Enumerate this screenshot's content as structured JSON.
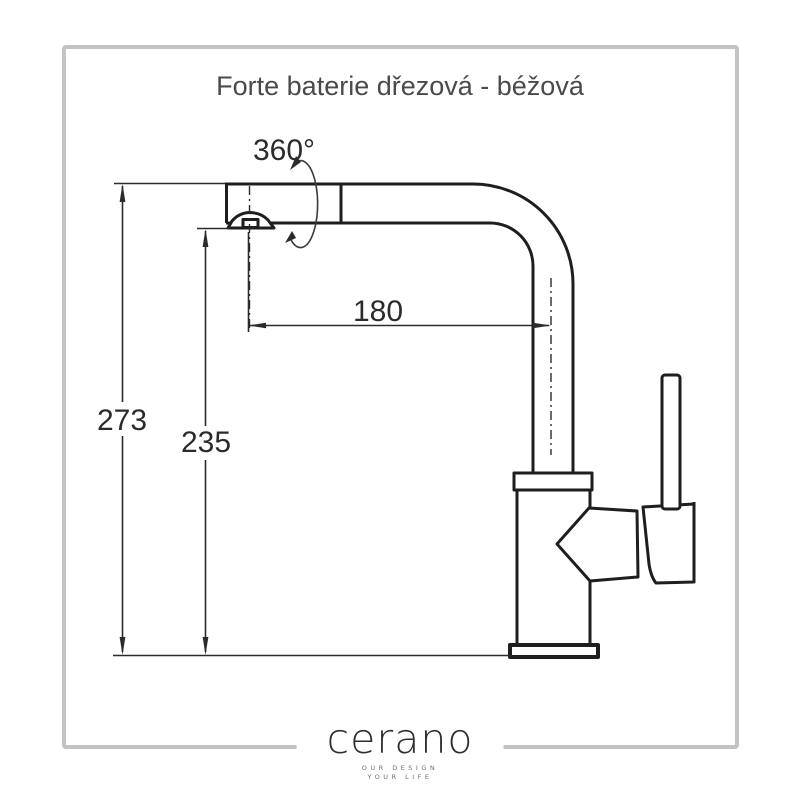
{
  "title": "Forte baterie dřezová - béžová",
  "dimensions": {
    "height_total": "273",
    "height_spout": "235",
    "reach": "180",
    "rotation": "360°"
  },
  "logo": {
    "brand": "cerano",
    "tagline_line1": "OUR DESIGN",
    "tagline_line2": "YOUR LIFE"
  },
  "colors": {
    "background": "#ffffff",
    "drawing_line": "#1e1e1e",
    "dimension_line": "#2b2b2b",
    "frame_border": "#c3c3c3",
    "title_text": "#4a4a4a",
    "logo_text": "#2e2e2e"
  }
}
